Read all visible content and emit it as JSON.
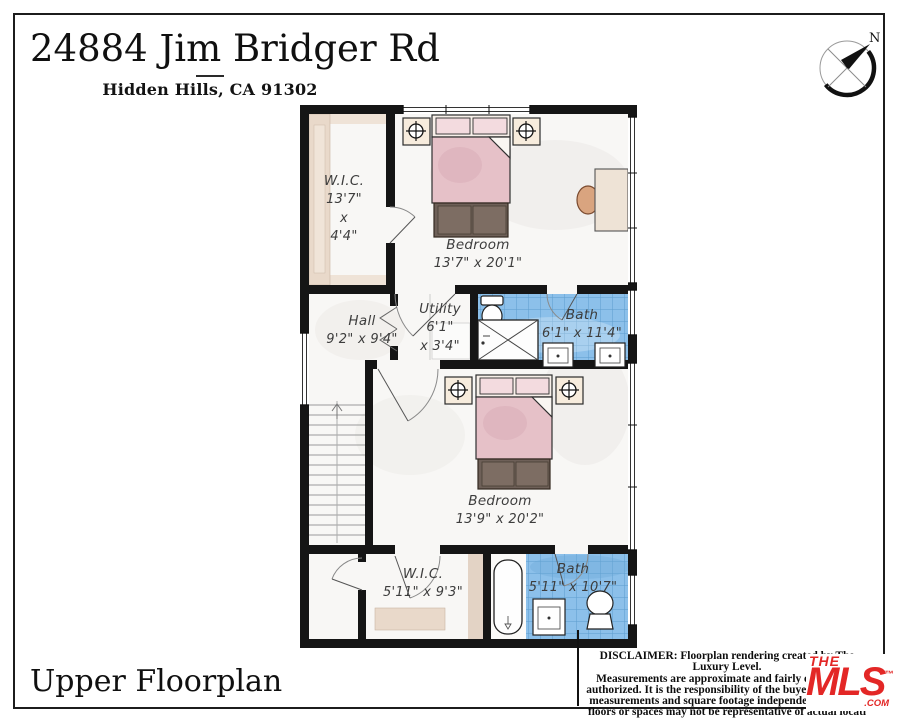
{
  "header": {
    "title": "24884 Jim Bridger Rd",
    "subtitle": "Hidden Hills, CA 91302"
  },
  "compass": {
    "north_label": "N"
  },
  "floorplan": {
    "rooms": {
      "wic_upper": {
        "name": "W.I.C.",
        "dim1": "13'7\"",
        "dim2": "x",
        "dim3": "4'4\""
      },
      "bedroom_upper": {
        "name": "Bedroom",
        "dims": "13'7\" x 20'1\""
      },
      "hall": {
        "name": "Hall",
        "dims": "9'2\" x 9'4\""
      },
      "utility": {
        "name": "Utility",
        "dim1": "6'1\"",
        "dim2": "x 3'4\""
      },
      "bath_upper": {
        "name": "Bath",
        "dims": "6'1\" x 11'4\""
      },
      "bedroom_lower": {
        "name": "Bedroom",
        "dims": "13'9\" x 20'2\""
      },
      "wic_lower": {
        "name": "W.I.C.",
        "dims": "5'11\" x 9'3\""
      },
      "bath_lower": {
        "name": "Bath",
        "dims": "5'11\" x 10'7\""
      }
    }
  },
  "footer": {
    "plan_label": "Upper Floorplan",
    "disclaimer_lines": [
      "DISCLAIMER: Floorplan rendering created by The Luxury Level.",
      "Measurements are approximate and fairly exact but n",
      "authorized. It is the responsibility of the buyer to verify th",
      "measurements and square footage independently. Multip",
      "floors or spaces may not be representative of actual locati"
    ],
    "logo": {
      "the": "THE",
      "mls": "MLS",
      "tm": "™",
      "com": ".COM"
    }
  },
  "colors": {
    "wall": "#151515",
    "tile_blue": "#8cc0ea",
    "blanket_pink": "#e6c1c8",
    "wood_tan": "#e9d9ca",
    "logo_red": "#e32726"
  }
}
